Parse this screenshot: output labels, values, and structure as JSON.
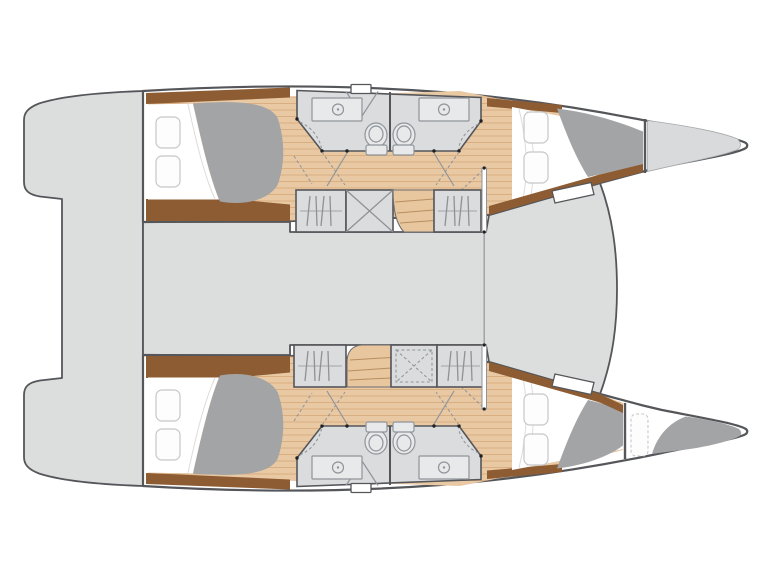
{
  "document": {
    "title": "Catamaran interior deck plan",
    "kind": "yacht-floor-plan-drawing",
    "visible_text": "none"
  },
  "canvas": {
    "width": 770,
    "height": 577,
    "background": "#ffffff"
  },
  "colors": {
    "outline": "#55565a",
    "deck": "#dcdddd",
    "hull_fill": "#ffffff",
    "wood_floor": "#e9c9a4",
    "wood_plank_line": "#d8ab7d",
    "stair_wood": "#e8c79e",
    "stair_line": "#b68e60",
    "trim_brown": "#8d5c33",
    "duvet_gray": "#a3a4a6",
    "pillow_fill": "#fdfdfd",
    "pillow_stroke": "#c5c7c8",
    "fixture_stroke": "#8f959a",
    "fixture_fill": "#e8e9ea",
    "cabinet_fill": "#dbdcdd",
    "hanger_line": "#8e9296",
    "joint_dot": "#1f2022",
    "bow_locker": "#d9dadb",
    "sheet_fold": "#dcdcdc"
  },
  "vessel": {
    "type": "sailing catamaran",
    "view": "overhead interior deck plan",
    "orientation": "bows to the right, sterns to the left",
    "bridge_deck": {
      "aft_platform": "grey transom platform joining both sugar-scoop sterns",
      "saloon_deck": "undetailed grey central deck between hulls",
      "foredeck": "tapered grey deck point between the bows",
      "mast_support": "white post pair with centre line between hulls"
    },
    "port_hull": {
      "position": "top",
      "rooms": [
        {
          "name": "aft double cabin",
          "berth": "double",
          "pillows": 2,
          "duvet": "grey"
        },
        {
          "name": "head compartment aft",
          "fixtures": [
            "washbasin counter",
            "toilet",
            "shower curtain arc"
          ]
        },
        {
          "name": "head compartment forward",
          "fixtures": [
            "washbasin counter",
            "toilet",
            "shower curtain arc"
          ]
        },
        {
          "name": "hanging locker aft",
          "symbol": "clothes hangers on rod"
        },
        {
          "name": "storage locker",
          "symbol": "crossed diagonals"
        },
        {
          "name": "companionway stairs",
          "symbol": "wood treads"
        },
        {
          "name": "hanging locker forward",
          "symbol": "clothes hangers on rod"
        },
        {
          "name": "forward double cabin",
          "berth": "double",
          "pillows": 2,
          "duvet": "grey"
        },
        {
          "name": "bow locker",
          "content": "empty grey stowage to bow tip"
        }
      ]
    },
    "starboard_hull": {
      "position": "bottom",
      "rooms": [
        {
          "name": "aft double cabin",
          "berth": "double",
          "pillows": 2,
          "duvet": "grey"
        },
        {
          "name": "head compartment aft",
          "fixtures": [
            "washbasin counter",
            "toilet",
            "shower curtain arc"
          ]
        },
        {
          "name": "head compartment forward",
          "fixtures": [
            "washbasin counter",
            "toilet",
            "shower curtain arc"
          ]
        },
        {
          "name": "hanging locker aft",
          "symbol": "clothes hangers on rod"
        },
        {
          "name": "companionway stairs",
          "symbol": "wood treads"
        },
        {
          "name": "storage locker",
          "symbol": "dashed inset with crossed diagonals"
        },
        {
          "name": "hanging locker forward",
          "symbol": "clothes hangers on rod"
        },
        {
          "name": "forward double cabin",
          "berth": "double",
          "pillows": 2,
          "duvet": "grey"
        },
        {
          "name": "forepeak berth",
          "berth": "single skipper berth",
          "pillows": 1,
          "duvet": "grey"
        }
      ]
    }
  }
}
